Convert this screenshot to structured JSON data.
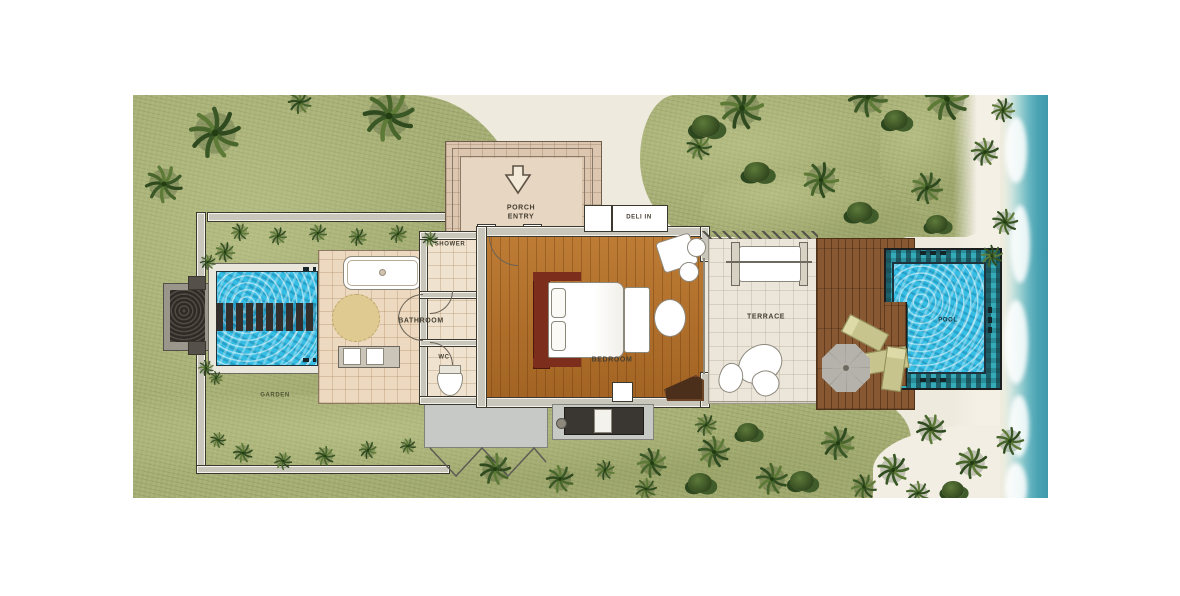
{
  "plan": {
    "type": "resort-villa-floor-plan",
    "rooms": {
      "porch_entry": "PORCH\nENTRY",
      "shower": "SHOWER",
      "deli_in": "DELI IN",
      "bathroom": "BATHROOM",
      "wc": "WC",
      "bedroom": "BEDROOM",
      "terrace": "TERRACE",
      "pool": "POOL",
      "garden": "GARDEN"
    },
    "icons": {
      "porch_entry_arrow": "down-arrow"
    },
    "colors": {
      "grass": "#a6ae74",
      "palm_foliage": "#3f5c2a",
      "sand": "#f1ede1",
      "ocean": "#49a3b3",
      "pool_water": "#35bde4",
      "pool_coping": "#2a8d9a",
      "lap_pool_water": "#35bde4",
      "deck_wood": "#875832",
      "bedroom_wood": "#b06c26",
      "bathroom_tile": "#ecd9bf",
      "porch_stone": "#dcc6b0",
      "terrace_floor": "#ece6da",
      "wall": "#3a382f",
      "headboard": "#7c2d1c"
    }
  }
}
